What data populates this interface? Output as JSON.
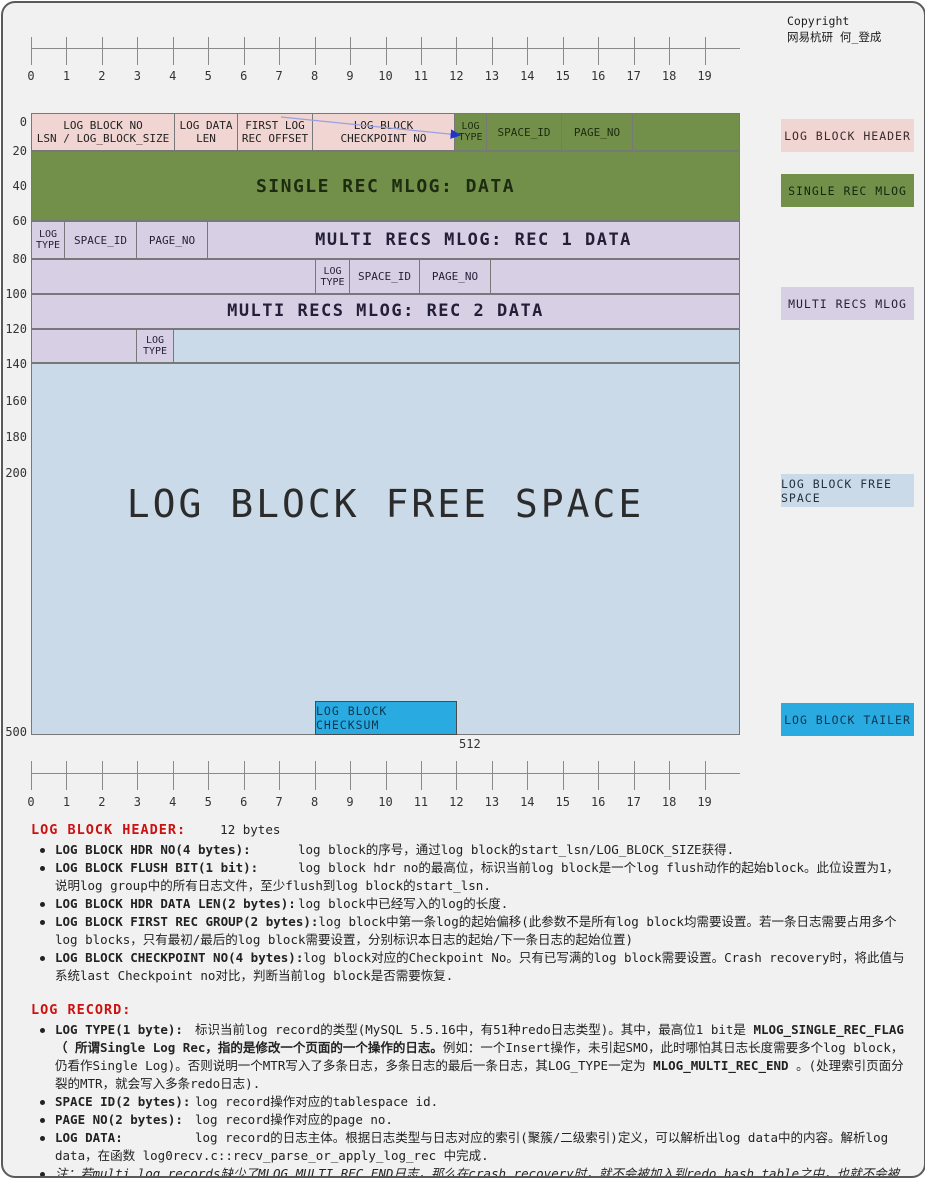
{
  "colors": {
    "pink": "#f0d5d3",
    "green": "#72904a",
    "purple": "#d7cfe3",
    "lblue": "#cadae9",
    "cyan": "#29abe2",
    "red": "#cc1111"
  },
  "copyright": {
    "line1": "Copyright",
    "line2": "网易杭研  何_登成"
  },
  "ruler": {
    "numbers": [
      "0",
      "1",
      "2",
      "3",
      "4",
      "5",
      "6",
      "7",
      "8",
      "9",
      "10",
      "11",
      "12",
      "13",
      "14",
      "15",
      "16",
      "17",
      "18",
      "19"
    ]
  },
  "scale": {
    "labels": [
      "0",
      "20",
      "40",
      "60",
      "80",
      "100",
      "120",
      "140",
      "160",
      "180",
      "200",
      "500"
    ],
    "end_label": "512"
  },
  "diagram": {
    "header": {
      "block_no_l1": "LOG BLOCK NO",
      "block_no_l2": "LSN / LOG_BLOCK_SIZE",
      "data_len_l1": "LOG DATA",
      "data_len_l2": "LEN",
      "first_rec_l1": "FIRST LOG",
      "first_rec_l2": "REC OFFSET",
      "checkpoint_l1": "LOG BLOCK",
      "checkpoint_l2": "CHECKPOINT NO",
      "log_type_l1": "LOG",
      "log_type_l2": "TYPE",
      "space_id": "SPACE_ID",
      "page_no": "PAGE_NO"
    },
    "single_rec": "SINGLE REC MLOG: DATA",
    "rec1": {
      "log_type_l1": "LOG",
      "log_type_l2": "TYPE",
      "space_id": "SPACE_ID",
      "page_no": "PAGE_NO",
      "data": "MULTI RECS MLOG: REC 1 DATA"
    },
    "rec2": {
      "log_type_l1": "LOG",
      "log_type_l2": "TYPE",
      "space_id": "SPACE_ID",
      "page_no": "PAGE_NO",
      "data": "MULTI RECS MLOG: REC 2 DATA"
    },
    "tail": {
      "log_type_l1": "LOG",
      "log_type_l2": "TYPE"
    },
    "free_space": "LOG BLOCK FREE SPACE",
    "checksum": "LOG BLOCK CHECKSUM"
  },
  "legend": {
    "header": "LOG BLOCK HEADER",
    "single": "SINGLE REC MLOG",
    "multi": "MULTI RECS MLOG",
    "free": "LOG BLOCK FREE SPACE",
    "tailer": "LOG BLOCK TAILER"
  },
  "header_section": {
    "title": "LOG BLOCK HEADER:",
    "size": "12 bytes",
    "bullets": [
      {
        "label": "LOG BLOCK HDR NO(4 bytes):",
        "desc": "log block的序号，通过log block的start_lsn/LOG_BLOCK_SIZE获得."
      },
      {
        "label": "LOG BLOCK FLUSH BIT(1 bit):",
        "desc": "log block hdr no的最高位，标识当前log block是一个log flush动作的起始block。此位设置为1，说明log group中的所有日志文件，至少flush到log block的start_lsn."
      },
      {
        "label": "LOG BLOCK HDR DATA LEN(2 bytes):",
        "desc": "log block中已经写入的log的长度."
      },
      {
        "label": "LOG BLOCK FIRST REC GROUP(2 bytes):",
        "desc": "log block中第一条log的起始偏移(此参数不是所有log block均需要设置。若一条日志需要占用多个log blocks，只有最初/最后的log block需要设置，分别标识本日志的起始/下一条日志的起始位置)"
      },
      {
        "label": "LOG BLOCK CHECKPOINT NO(4 bytes):",
        "desc": "log block对应的Checkpoint No。只有已写满的log block需要设置。Crash recovery时，将此值与系统last Checkpoint no对比，判断当前log block是否需要恢复."
      }
    ]
  },
  "record_section": {
    "title": "LOG RECORD:",
    "log_type": {
      "label": "LOG TYPE(1 byte):",
      "t1": "标识当前log record的类型(MySQL 5.5.16中，有51种redo日志类型)。其中，最高位1 bit是 ",
      "b1": "MLOG_SINGLE_REC_FLAG （ 所谓Single Log Rec，指的是修改一个页面的一个操作的日志。",
      "t2": "例如：一个Insert操作，未引起SMO，此时哪怕其日志长度需要多个log block，仍看作Single Log)。否则说明一个MTR写入了多条日志，多条日志的最后一条日志，其LOG_TYPE一定为 ",
      "b2": "MLOG_MULTI_REC_END",
      "t3": " 。(处理索引页面分裂的MTR，就会写入多条redo日志)."
    },
    "bullets": [
      {
        "label": "SPACE ID(2 bytes):",
        "desc": "log record操作对应的tablespace id."
      },
      {
        "label": "PAGE NO(2 bytes):",
        "desc": "log record操作对应的page no."
      },
      {
        "label": "LOG DATA:",
        "desc": "log record的日志主体。根据日志类型与日志对应的索引(聚簇/二级索引)定义，可以解析出log data中的内容。解析log data，在函数 log0recv.c::recv_parse_or_apply_log_rec 中完成."
      }
    ]
  },
  "note": {
    "prefix": "注：",
    "text": "若multi log records缺少了MLOG_MULTI_REC_END日志，那么在crash recovery时，就不会被加入到redo hash table之中，也就不会被redo。Multi log records，要么全部redo，要么丢弃都不redo。"
  }
}
